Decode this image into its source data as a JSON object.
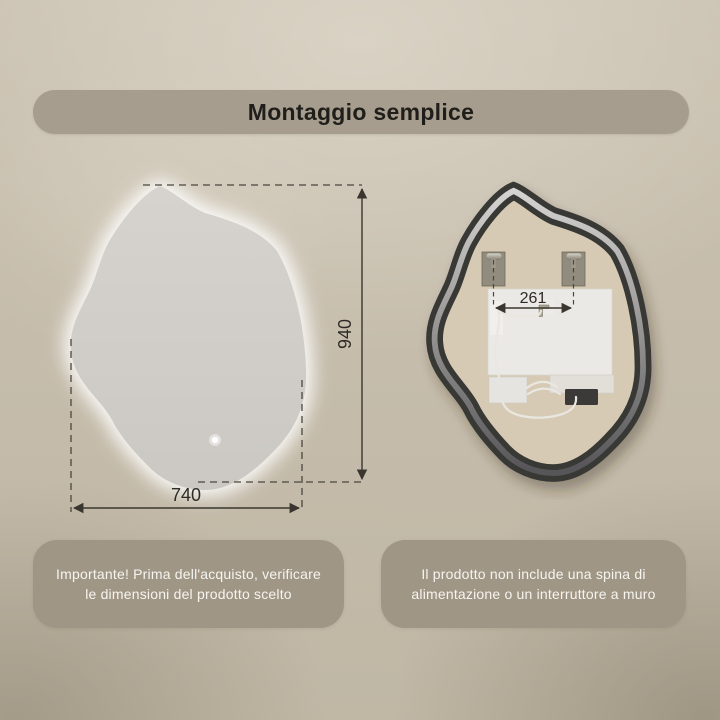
{
  "page": {
    "title_banner": "Montaggio semplice"
  },
  "front_view": {
    "description": "front view of irregular backlit mirror with overall dimensions",
    "width_label": "740",
    "height_label": "940",
    "led_indicator": "power-led-dot"
  },
  "back_view": {
    "description": "back view of mirror showing frame, mounting brackets and led driver",
    "bracket_distance_label": "261"
  },
  "notes": {
    "left": {
      "lines": [
        "Importante! Prima dell'acquisto, verificare",
        "le dimensioni del prodotto scelto"
      ]
    },
    "right": {
      "lines": [
        "Il prodotto non include una spina di",
        "alimentazione o un interruttore a muro"
      ]
    }
  },
  "colors": {
    "wall": "#c6bdac",
    "title_pill": "#a69d8e",
    "title_text": "#201e1a",
    "note_pill": "#a09686",
    "note_text": "#f6f4ef",
    "dimension_lines": "#3a362f",
    "mirror_surface": "#d2cfca",
    "mirror_glow": "#ffffff",
    "frame_dark": "#383735",
    "frame_silver": "#c9c8c5",
    "backing_board": "#d7cab4",
    "power_connector": "#3b3a38"
  }
}
